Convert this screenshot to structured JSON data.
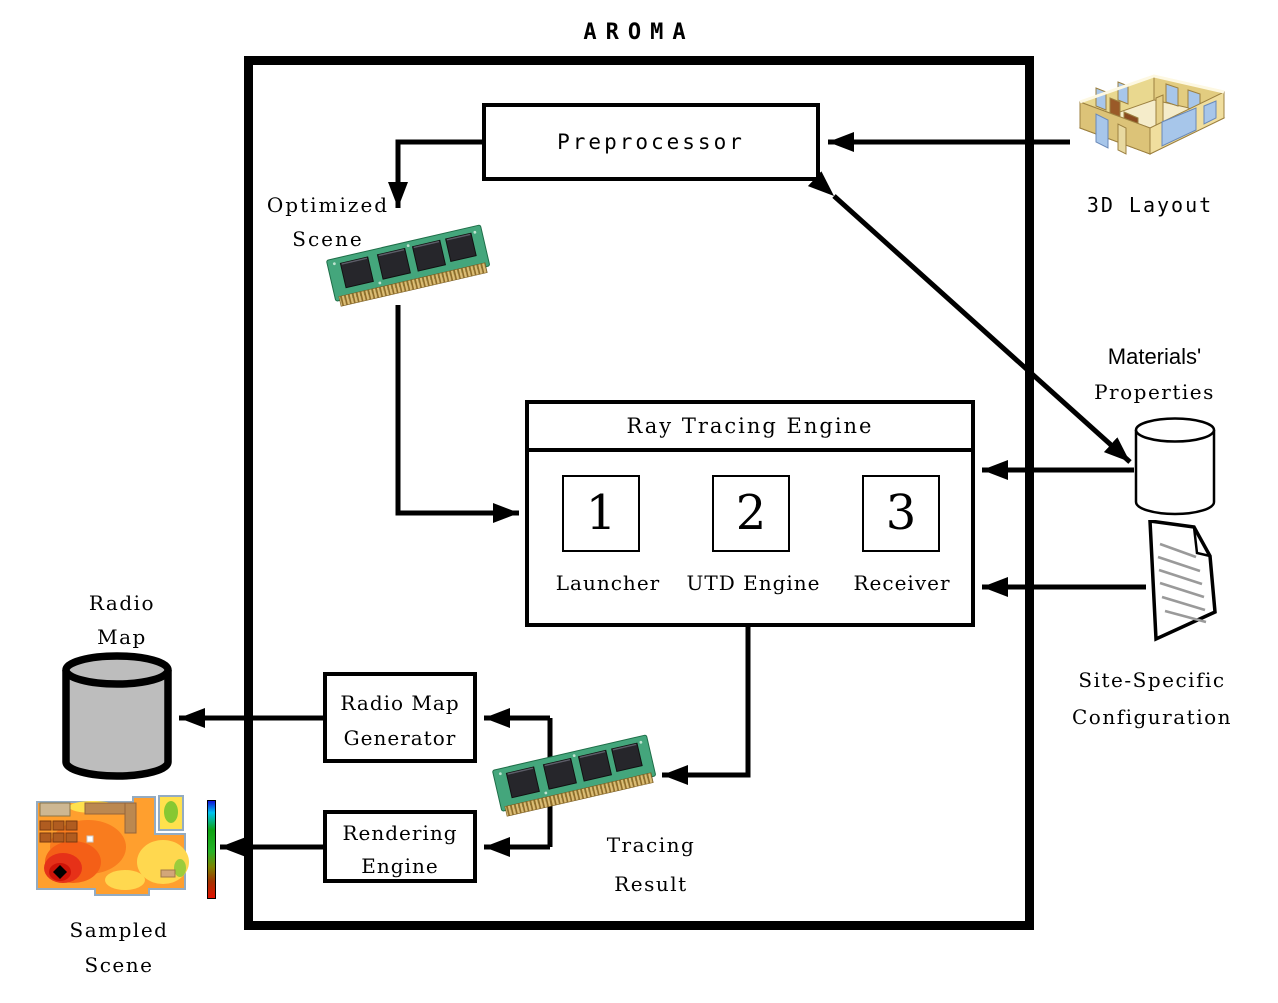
{
  "title": "AROMA",
  "preprocessor": {
    "label": "Preprocessor"
  },
  "optimized_scene": {
    "line1": "Optimized",
    "line2": "Scene"
  },
  "rte": {
    "title": "Ray Tracing Engine",
    "components": [
      {
        "number": "1",
        "label": "Launcher"
      },
      {
        "number": "2",
        "label": "UTD Engine"
      },
      {
        "number": "3",
        "label": "Receiver"
      }
    ]
  },
  "layout_3d": {
    "label": "3D Layout"
  },
  "materials": {
    "line1": "Materials'",
    "line2": "Properties"
  },
  "site_specific": {
    "line1": "Site-Specific",
    "line2": "Configuration"
  },
  "radio_map": {
    "line1": "Radio",
    "line2": "Map"
  },
  "radio_map_generator": {
    "line1": "Radio Map",
    "line2": "Generator"
  },
  "rendering_engine": {
    "line1": "Rendering",
    "line2": "Engine"
  },
  "tracing_result": {
    "line1": "Tracing",
    "line2": "Result"
  },
  "sampled_scene": {
    "line1": "Sampled",
    "line2": "Scene"
  },
  "colors": {
    "line_and_border": "#000000",
    "radio_map_cylinder_fill": "#bdbdbd",
    "chip_pcb_green": "#44a67c",
    "chip_gold_edge": "#d6b266",
    "building_wall_tan": "#eedc9c",
    "building_window_blue": "#a7c6ea",
    "heatmap_hot_red": "#e63118",
    "heatmap_mid_orange": "#ff9f2e",
    "heatmap_warm_yellow": "#ffd84f",
    "heatmap_cool_green": "#9ccc3c",
    "colorbar_top_blue": "#1212d8",
    "colorbar_bottom_red": "#e21000"
  }
}
